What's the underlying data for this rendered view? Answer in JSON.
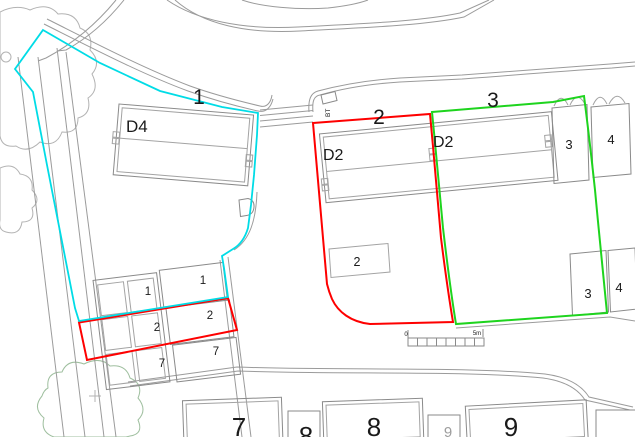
{
  "colors": {
    "plot1_boundary": "#00dce6",
    "plot2_boundary": "#fe0000",
    "plot3_boundary": "#1ed41e",
    "tree_canopy": "#9fbf9f"
  },
  "plot_labels": {
    "plot1": "1",
    "plot2": "2",
    "plot3": "3"
  },
  "house_labels": {
    "d4": "D4",
    "d2_left": "D2",
    "d2_right": "D2"
  },
  "garage_labels": {
    "top_3": "3",
    "top_4": "4",
    "bottom_3": "3",
    "bottom_4": "4"
  },
  "garden_plots": {
    "middle_column": [
      "1",
      "2",
      "7"
    ],
    "right_column": [
      "1",
      "2",
      "7"
    ]
  },
  "parking_label": "2",
  "street_buildings": {
    "b7": "7",
    "b8_small": "8",
    "b8": "8",
    "b9_small": "9",
    "b9": "9"
  },
  "scale_bar": {
    "zero": "0",
    "five_m": "5m"
  },
  "bt_label": "BT"
}
